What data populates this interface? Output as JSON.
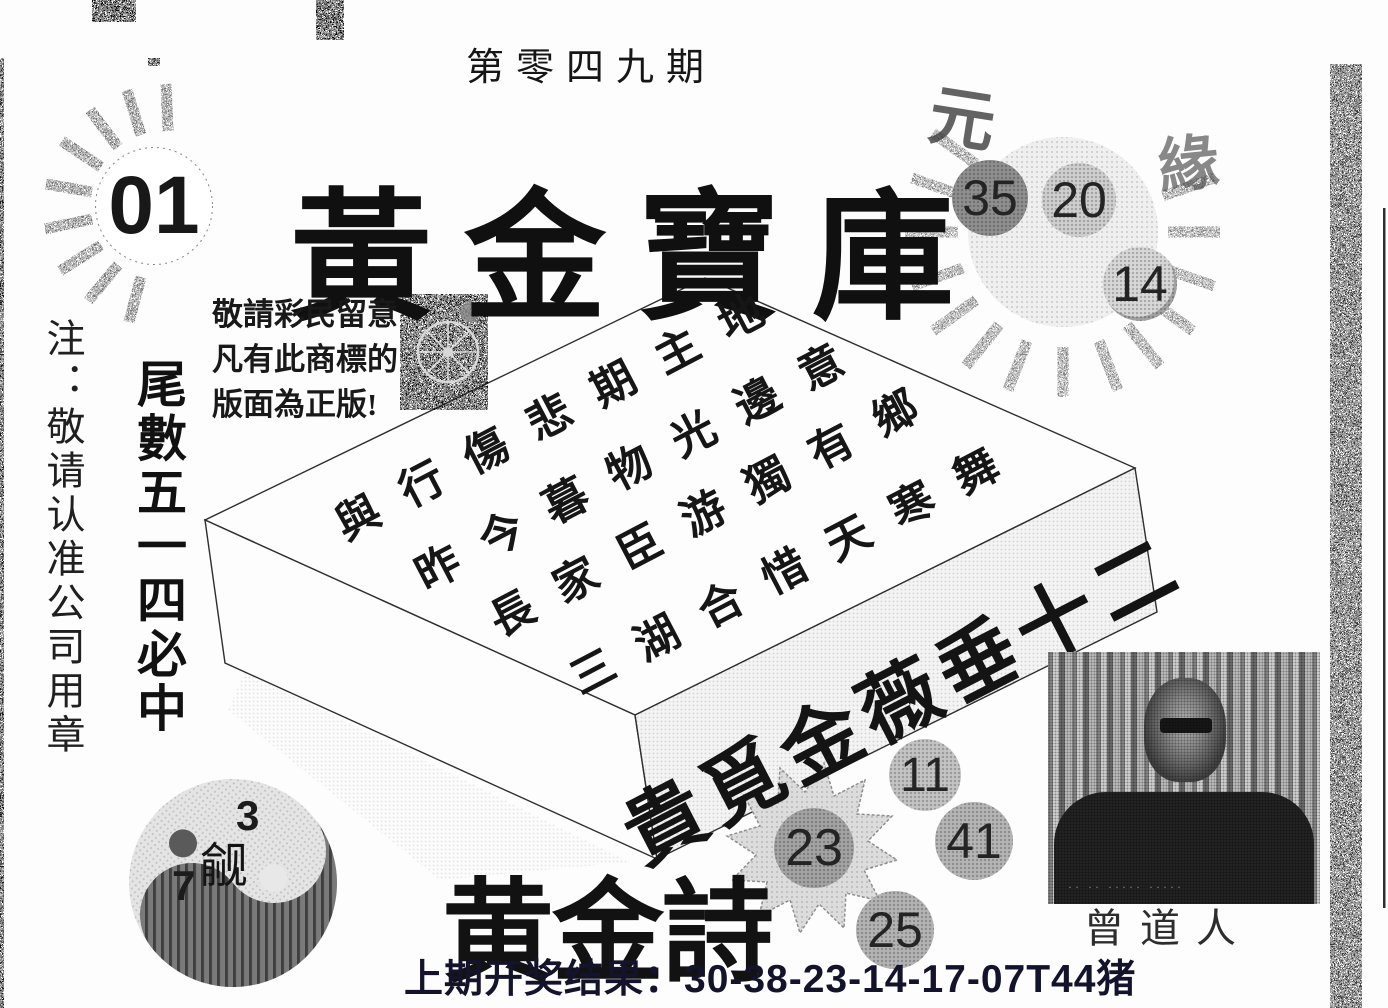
{
  "page": {
    "issue_title": "第零四九期"
  },
  "header": {
    "corner_ball": "01",
    "main_title": "黃金寶庫",
    "sun_balls": [
      "35",
      "20",
      "14"
    ],
    "calligraphy_marks": [
      "元",
      "緣"
    ]
  },
  "notice": {
    "lines": "敬請彩民留意\n凡有此商標的\n版面為正版!"
  },
  "side_notes": {
    "left_note": "注：敬请认准公司用章",
    "tail_tip": "尾數五一四必中"
  },
  "box": {
    "poem_lines": [
      "與行傷悲期主地",
      "昨今暮物光邊意",
      "長家臣游獨有鄉",
      "三湖合惜天寒舞"
    ],
    "band_text": "貴覓金薇垂十二"
  },
  "yinyang": {
    "top_number": "3",
    "bottom_number": "7",
    "character": "觎"
  },
  "golden_poem_title": "黄金詩",
  "lucky_numbers": {
    "starburst": "23",
    "plain": [
      "11",
      "41",
      "25"
    ]
  },
  "portrait": {
    "caption": "曾道人",
    "dotted_line": "·· ·· ····· ·····"
  },
  "footer": {
    "last_result": "上期开奖结果：30-38-23-14-17-07T44猪"
  },
  "colors": {
    "ink": "#1a1a1a",
    "result_text": "#13132b",
    "ball_dark": "#8f8f8f",
    "ball_light": "#cfcfcf",
    "paper": "#fdfdfd"
  }
}
